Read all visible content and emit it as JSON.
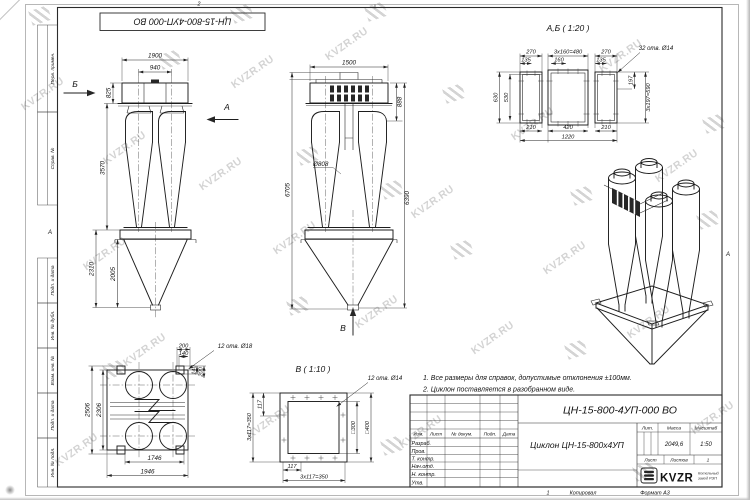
{
  "watermark": {
    "text": "KVZR.RU"
  },
  "frame": {
    "top_stamp": "ЦН-15-800-4УП-000 ВО",
    "zone_top": "2",
    "zone_left": "А",
    "zone_right": "А",
    "left_labels": [
      "Перв. примен.",
      "Справ. №",
      "Подп. и дата",
      "Инв. № дубл.",
      "Взам. инв. №",
      "Подп. и дата",
      "Инв. № подл."
    ]
  },
  "views": {
    "side": {
      "arrow_b": "Б",
      "arrow_a": "А",
      "dim_1900": "1900",
      "dim_940": "940",
      "dim_825": "825",
      "dim_3570": "3570",
      "dim_2310": "2310",
      "dim_2005": "2005"
    },
    "front": {
      "dim_1500": "1500",
      "dim_888": "888",
      "dim_d808": "Ø808",
      "dim_6705": "6705",
      "dim_6390": "6390",
      "arrow_v": "В"
    },
    "section_ab": {
      "title": "А,Б ( 1:20 )",
      "callout": "32 отв. Ø14",
      "dim_270_l": "270",
      "dim_480": "3х160=480",
      "dim_270_r": "270",
      "dim_135_l": "135",
      "dim_160": "160",
      "dim_135_r": "135",
      "dim_630": "630",
      "dim_530": "530",
      "dim_197": "197",
      "dim_590": "3х197=590",
      "dim_210_l": "210",
      "dim_420": "420",
      "dim_210_r": "210",
      "dim_1220": "1220"
    },
    "plan": {
      "callout": "12 отв. Ø18",
      "dim_200_t": "200",
      "dim_140_t": "140",
      "dim_140_r": "140",
      "dim_200_r": "200",
      "dim_2506": "2506",
      "dim_2306": "2306",
      "dim_1746": "1746",
      "dim_1946": "1946"
    },
    "section_v": {
      "title": "В ( 1:10 )",
      "callout": "12 отв. Ø14",
      "dim_117_l": "117",
      "dim_350_l": "3х117=350",
      "dim_117_b": "117",
      "dim_350_b": "3х117=350",
      "dim_300": "□300",
      "dim_400": "□400"
    }
  },
  "notes": [
    "1. Все размеры для справок, допустимые отклонения ±100мм.",
    "2. Циклон поставляется в разобранном виде."
  ],
  "title_block": {
    "designation": "ЦН-15-800-4УП-000 ВО",
    "product_name": "Циклон ЦН-15-800х4УП",
    "cols": [
      "Изм.",
      "Лист",
      "№ докум.",
      "Подп.",
      "Дата"
    ],
    "rows": [
      "Разраб.",
      "Пров.",
      "Т. контр.",
      "Нач.отд.",
      "Н. контр.",
      "Утв."
    ],
    "lit_label": "Лит.",
    "mass_label": "Масса",
    "scale_label": "Масштаб",
    "mass_value": "2049,6",
    "scale_value": "1:50",
    "sheet_label": "Лист",
    "sheets_label": "Листов",
    "sheets_value": "1",
    "brand": "KVZR",
    "brand_sub1": "Котельный",
    "brand_sub2": "завод РЭП",
    "copy_num": "1",
    "copied_label": "Копировал",
    "format_label": "Формат А3"
  }
}
